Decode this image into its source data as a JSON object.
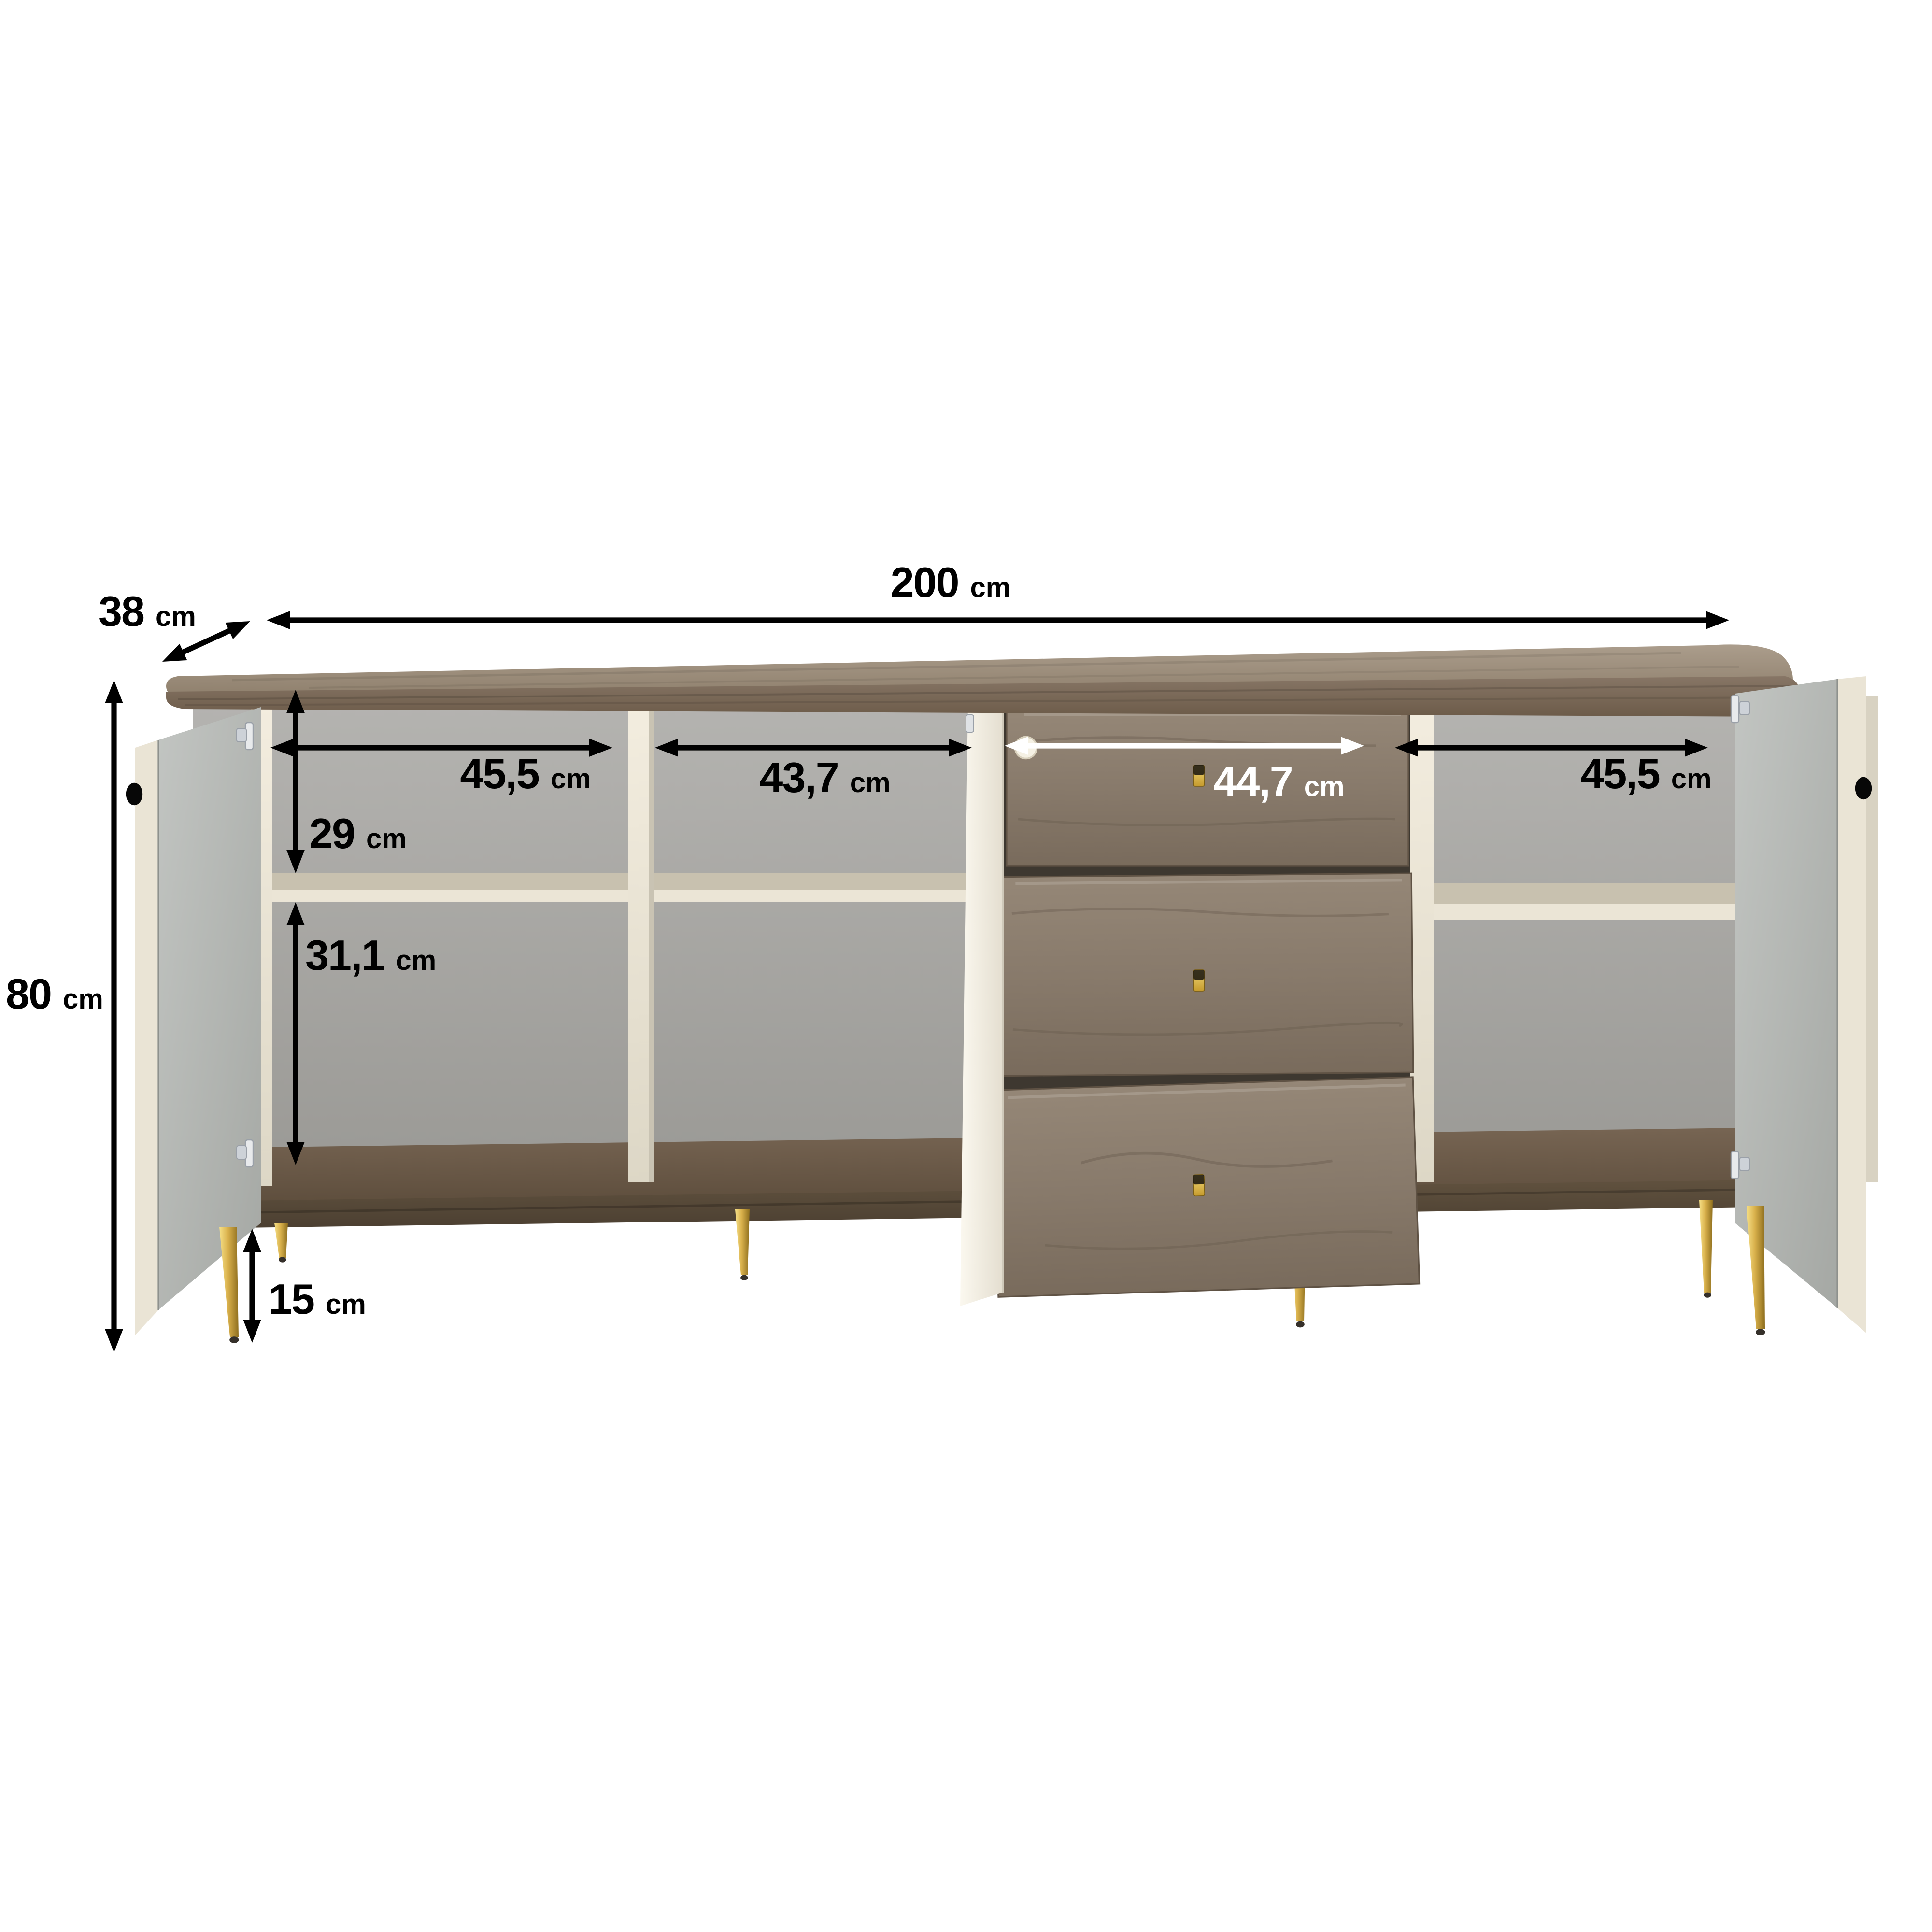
{
  "diagram": {
    "subject": "sideboard-dimensions",
    "dimensions": {
      "width": {
        "value": "200",
        "unit": "cm"
      },
      "depth": {
        "value": "38",
        "unit": "cm"
      },
      "height": {
        "value": "80",
        "unit": "cm"
      },
      "left_compartment_width": {
        "value": "45,5",
        "unit": "cm"
      },
      "center_compartment_width": {
        "value": "43,7",
        "unit": "cm"
      },
      "drawer_width": {
        "value": "44,7",
        "unit": "cm"
      },
      "right_compartment_width": {
        "value": "45,5",
        "unit": "cm"
      },
      "upper_compartment_height": {
        "value": "29",
        "unit": "cm"
      },
      "lower_compartment_height": {
        "value": "31,1",
        "unit": "cm"
      },
      "leg_height": {
        "value": "15",
        "unit": "cm"
      }
    },
    "colors": {
      "background": "#ffffff",
      "dimension_line": "#000000",
      "dimension_line_on_wood": "#ffffff",
      "gold_accent": "#d2ab45",
      "wood_top": "#9c8d7b",
      "wood_drawer": "#877a6b",
      "wood_bottom": "#5a4c3d",
      "carcass_cream": "#ece6d7",
      "door_inner_gray": "#b1b4b0",
      "interior_gray": "#a9a8a5"
    }
  }
}
